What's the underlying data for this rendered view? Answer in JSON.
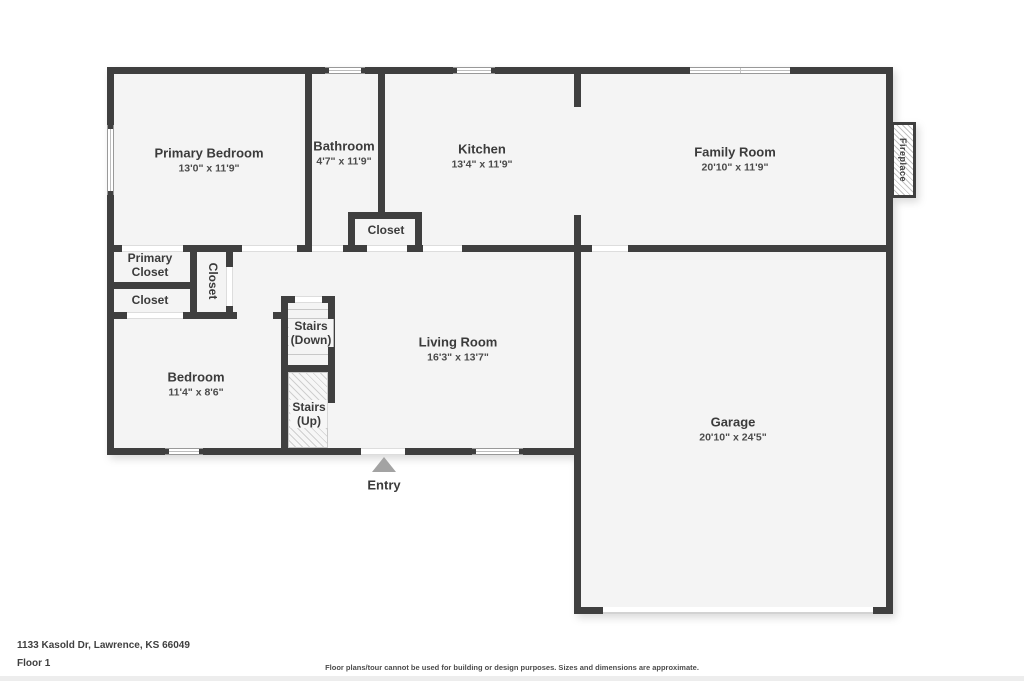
{
  "colors": {
    "wall": "#3f3f3f",
    "floor": "#f4f4f4",
    "label_text": "#3b3b3b",
    "entry_arrow": "#a3a3a3"
  },
  "rooms": [
    {
      "name": "Primary Bedroom",
      "dims": "13'0\" x 11'9\""
    },
    {
      "name": "Bathroom",
      "dims": "4'7\" x 11'9\""
    },
    {
      "name": "Kitchen",
      "dims": "13'4\" x 11'9\""
    },
    {
      "name": "Family Room",
      "dims": "20'10\" x 11'9\""
    },
    {
      "name": "Living Room",
      "dims": "16'3\" x 13'7\""
    },
    {
      "name": "Bedroom",
      "dims": "11'4\" x 8'6\""
    },
    {
      "name": "Garage",
      "dims": "20'10\" x 24'5\""
    }
  ],
  "labels": {
    "closet_bath": "Closet",
    "primary_closet": "Primary Closet",
    "closet_left": "Closet",
    "closet_vertical": "Closet",
    "stairs_down_line1": "Stairs",
    "stairs_down_line2": "(Down)",
    "stairs_up_line1": "Stairs",
    "stairs_up_line2": "(Up)",
    "entry": "Entry",
    "fireplace": "Fireplace"
  },
  "footer": {
    "address": "1133 Kasold Dr, Lawrence, KS 66049",
    "floor": "Floor 1",
    "disclaimer": "Floor plans/tour cannot be used for building or design purposes. Sizes and dimensions are approximate."
  }
}
